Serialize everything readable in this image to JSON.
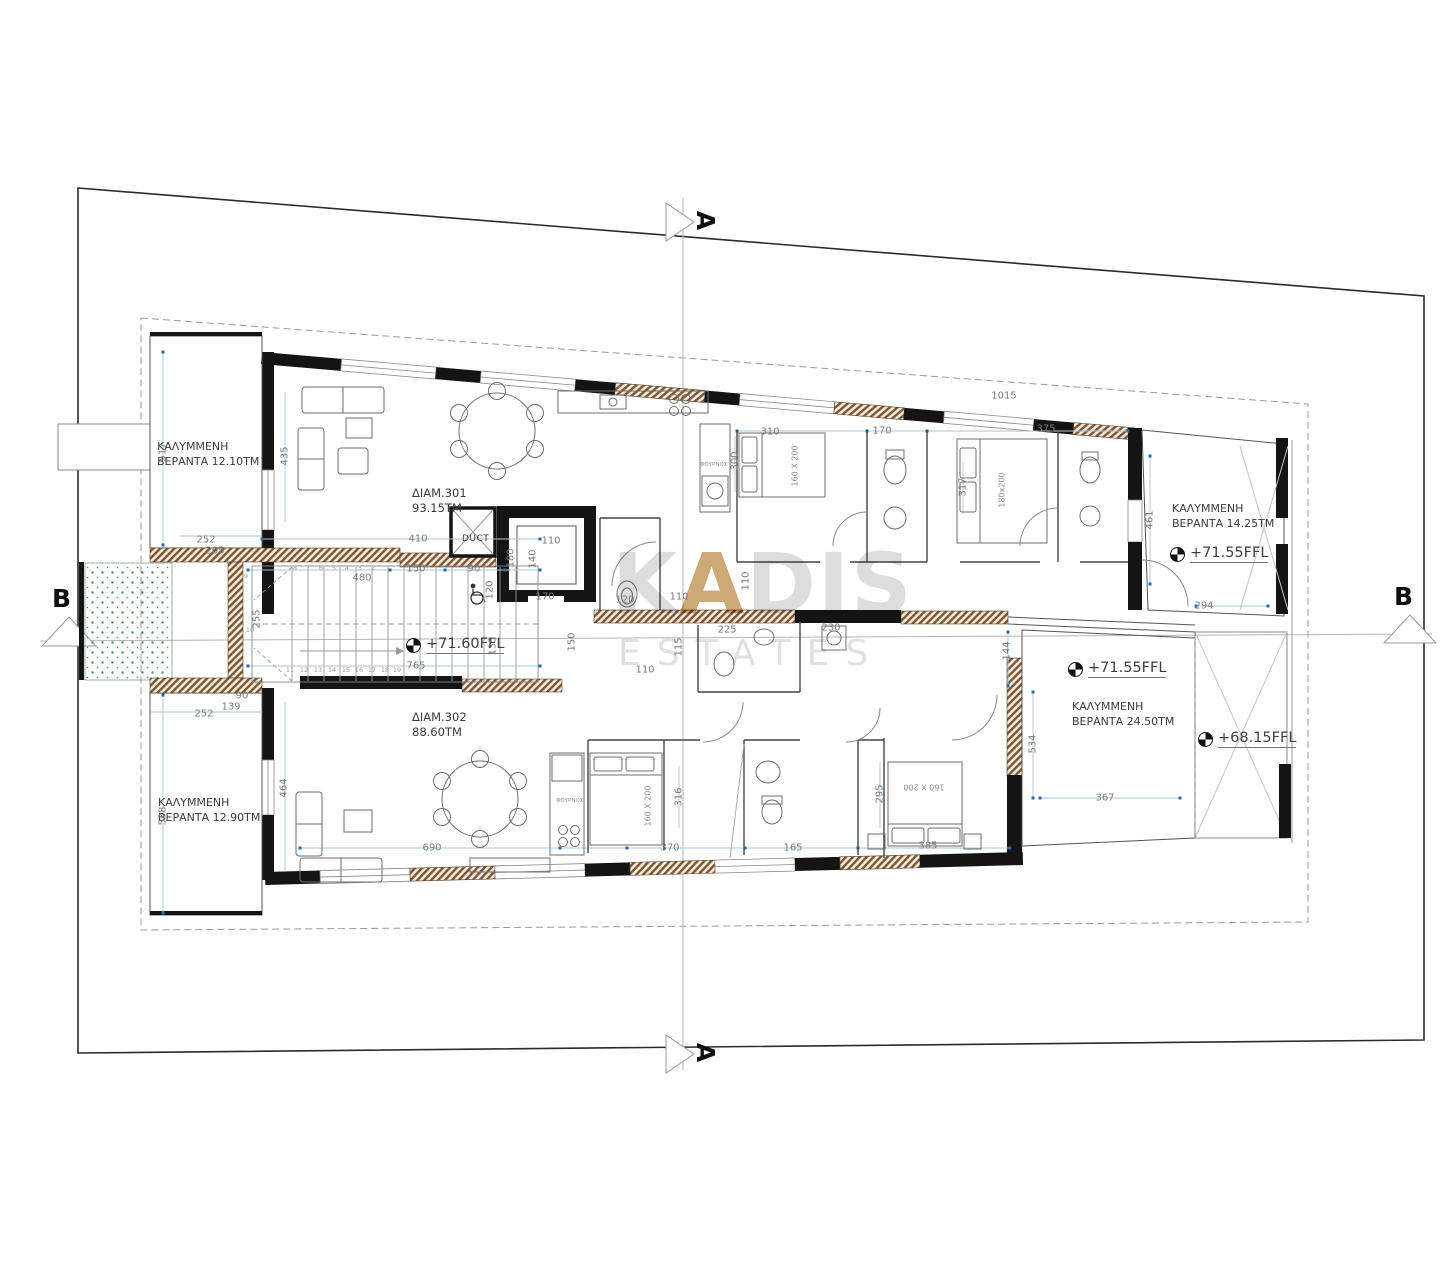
{
  "title": "Floor plan – 3rd floor, two apartments",
  "watermark": {
    "brand_prefix": "K",
    "brand_accent": "A",
    "brand_suffix": "DIS",
    "brand_sub": "ESTATES"
  },
  "section_markers": {
    "top": "A",
    "bottom": "A",
    "left": "B",
    "right": "B"
  },
  "apartments": [
    "ΔΙΑΜ.301\n93.15ΤΜ",
    "ΔΙΑΜ.302\n88.60ΤΜ"
  ],
  "verandas": [
    "ΚΑΛΥΜΜΕΝΗ\nΒΕΡΑΝΤΑ 12.10ΤΜ",
    "ΚΑΛΥΜΜΕΝΗ\nΒΕΡΑΝΤΑ 14.25ΤΜ",
    "ΚΑΛΥΜΜΕΝΗ\nΒΕΡΑΝΤΑ 24.50ΤΜ",
    "ΚΑΛΥΜΜΕΝΗ\nΒΕΡΑΝΤΑ 12.90ΤΜ"
  ],
  "levels": [
    "+71.60FFL",
    "+71.55FFL",
    "+71.55FFL",
    "+68.15FFL"
  ],
  "rooms": {
    "duct": "DUCT",
    "oven": "ΦΟΥΡΝΟΣ"
  },
  "beds": [
    "160 X 200",
    "180x200",
    "160 X 200",
    "160 X 200"
  ],
  "colors": {
    "dimension_blue": "#2a6aa8",
    "hatch_brown": "#7a5638",
    "planter_green": "#4e8f66",
    "watermark_gold": "#c49a5f"
  },
  "dimensions": [
    {
      "t": "517",
      "x": 163,
      "y": 452,
      "v": true
    },
    {
      "t": "435",
      "x": 285,
      "y": 456,
      "v": true
    },
    {
      "t": "252",
      "x": 206,
      "y": 540
    },
    {
      "t": "205",
      "x": 215,
      "y": 551
    },
    {
      "t": "410",
      "x": 418,
      "y": 539
    },
    {
      "t": "480",
      "x": 362,
      "y": 578
    },
    {
      "t": "150",
      "x": 416,
      "y": 569
    },
    {
      "t": "90",
      "x": 474,
      "y": 569
    },
    {
      "t": "255",
      "x": 257,
      "y": 619,
      "v": true
    },
    {
      "t": "765",
      "x": 416,
      "y": 666
    },
    {
      "t": "135",
      "x": 493,
      "y": 646,
      "v": true
    },
    {
      "t": "150",
      "x": 572,
      "y": 642,
      "v": true
    },
    {
      "t": "110",
      "x": 551,
      "y": 541
    },
    {
      "t": "180",
      "x": 511,
      "y": 558,
      "v": true
    },
    {
      "t": "140",
      "x": 533,
      "y": 559,
      "v": true
    },
    {
      "t": "170",
      "x": 545,
      "y": 597
    },
    {
      "t": "120",
      "x": 490,
      "y": 590,
      "v": true
    },
    {
      "t": "90",
      "x": 242,
      "y": 696
    },
    {
      "t": "139",
      "x": 231,
      "y": 707
    },
    {
      "t": "252",
      "x": 204,
      "y": 714
    },
    {
      "t": "538",
      "x": 163,
      "y": 816,
      "v": true
    },
    {
      "t": "464",
      "x": 284,
      "y": 788,
      "v": true
    },
    {
      "t": "1015",
      "x": 1004,
      "y": 396
    },
    {
      "t": "310",
      "x": 770,
      "y": 432
    },
    {
      "t": "170",
      "x": 882,
      "y": 431
    },
    {
      "t": "375",
      "x": 1046,
      "y": 429
    },
    {
      "t": "300",
      "x": 735,
      "y": 461,
      "v": true
    },
    {
      "t": "317",
      "x": 963,
      "y": 487,
      "v": true
    },
    {
      "t": "461",
      "x": 1150,
      "y": 520,
      "v": true
    },
    {
      "t": "294",
      "x": 1204,
      "y": 606
    },
    {
      "t": "144",
      "x": 1007,
      "y": 651,
      "v": true
    },
    {
      "t": "110",
      "x": 679,
      "y": 597
    },
    {
      "t": "120",
      "x": 625,
      "y": 600
    },
    {
      "t": "225",
      "x": 727,
      "y": 630
    },
    {
      "t": "230",
      "x": 831,
      "y": 628
    },
    {
      "t": "115",
      "x": 679,
      "y": 647,
      "v": true
    },
    {
      "t": "110",
      "x": 645,
      "y": 670
    },
    {
      "t": "110",
      "x": 746,
      "y": 581,
      "v": true
    },
    {
      "t": "690",
      "x": 432,
      "y": 848
    },
    {
      "t": "370",
      "x": 670,
      "y": 848
    },
    {
      "t": "165",
      "x": 793,
      "y": 848
    },
    {
      "t": "385",
      "x": 928,
      "y": 846
    },
    {
      "t": "316",
      "x": 679,
      "y": 797,
      "v": true
    },
    {
      "t": "295",
      "x": 880,
      "y": 794,
      "v": true
    },
    {
      "t": "534",
      "x": 1033,
      "y": 744,
      "v": true
    },
    {
      "t": "367",
      "x": 1105,
      "y": 798
    },
    {
      "t": "8",
      "x": 295,
      "y": 568,
      "s": true
    },
    {
      "t": "7",
      "x": 308,
      "y": 568,
      "s": true
    },
    {
      "t": "6",
      "x": 321,
      "y": 568,
      "s": true
    },
    {
      "t": "5",
      "x": 334,
      "y": 568,
      "s": true
    },
    {
      "t": "4",
      "x": 347,
      "y": 568,
      "s": true
    },
    {
      "t": "3",
      "x": 360,
      "y": 568,
      "s": true
    },
    {
      "t": "2",
      "x": 373,
      "y": 568,
      "s": true
    },
    {
      "t": "9",
      "x": 246,
      "y": 576,
      "s": true
    },
    {
      "t": "10",
      "x": 250,
      "y": 630,
      "s": true
    },
    {
      "t": "11",
      "x": 290,
      "y": 670,
      "s": true
    },
    {
      "t": "12",
      "x": 304,
      "y": 670,
      "s": true
    },
    {
      "t": "13",
      "x": 318,
      "y": 670,
      "s": true
    },
    {
      "t": "14",
      "x": 332,
      "y": 670,
      "s": true
    },
    {
      "t": "15",
      "x": 346,
      "y": 670,
      "s": true
    },
    {
      "t": "16",
      "x": 359,
      "y": 670,
      "s": true
    },
    {
      "t": "17",
      "x": 372,
      "y": 670,
      "s": true
    },
    {
      "t": "18",
      "x": 385,
      "y": 670,
      "s": true
    },
    {
      "t": "19",
      "x": 397,
      "y": 670,
      "s": true
    }
  ]
}
